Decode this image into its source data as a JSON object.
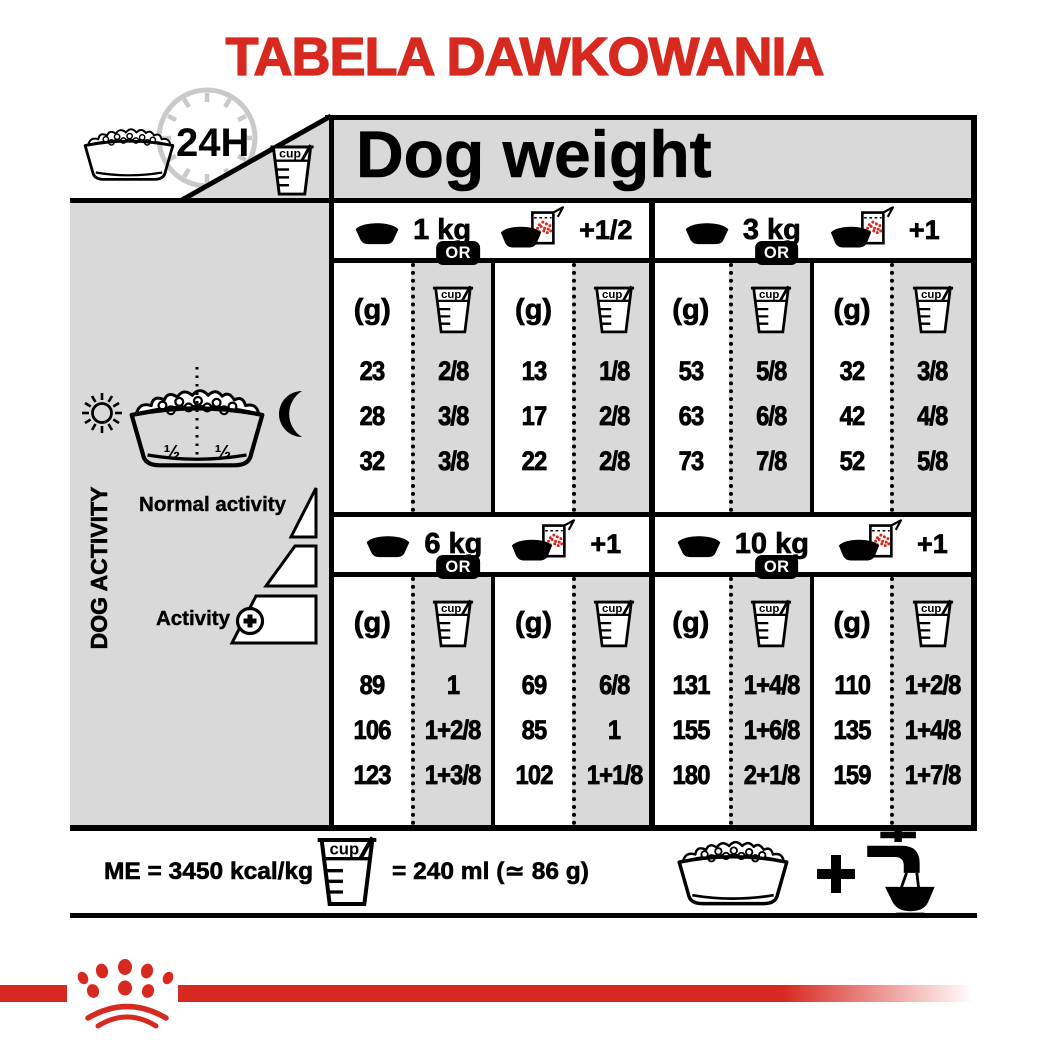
{
  "title": "TABELA DAWKOWANIA",
  "header": {
    "clock_label": "24H",
    "dog_weight_label": "Dog weight"
  },
  "sidebar": {
    "axis_label": "DOG ACTIVITY",
    "bowl_half_left": "½",
    "bowl_half_right": "½",
    "normal_activity_label": "Normal activity",
    "activity_label": "Activity"
  },
  "table": {
    "grams_header": "(g)",
    "cup_label": "cup",
    "or_label": "OR",
    "sections": [
      {
        "weight": "1 kg",
        "bag_extra": "+1/2",
        "bowl_grams": [
          "23",
          "28",
          "32"
        ],
        "bowl_cups": [
          "2/8",
          "3/8",
          "3/8"
        ],
        "bag_grams": [
          "13",
          "17",
          "22"
        ],
        "bag_cups": [
          "1/8",
          "2/8",
          "2/8"
        ]
      },
      {
        "weight": "3 kg",
        "bag_extra": "+1",
        "bowl_grams": [
          "53",
          "63",
          "73"
        ],
        "bowl_cups": [
          "5/8",
          "6/8",
          "7/8"
        ],
        "bag_grams": [
          "32",
          "42",
          "52"
        ],
        "bag_cups": [
          "3/8",
          "4/8",
          "5/8"
        ]
      },
      {
        "weight": "6 kg",
        "bag_extra": "+1",
        "bowl_grams": [
          "89",
          "106",
          "123"
        ],
        "bowl_cups": [
          "1",
          "1+2/8",
          "1+3/8"
        ],
        "bag_grams": [
          "69",
          "85",
          "102"
        ],
        "bag_cups": [
          "6/8",
          "1",
          "1+1/8"
        ]
      },
      {
        "weight": "10 kg",
        "bag_extra": "+1",
        "bowl_grams": [
          "131",
          "155",
          "180"
        ],
        "bowl_cups": [
          "1+4/8",
          "1+6/8",
          "2+1/8"
        ],
        "bag_grams": [
          "110",
          "135",
          "159"
        ],
        "bag_cups": [
          "1+2/8",
          "1+4/8",
          "1+7/8"
        ]
      }
    ]
  },
  "footer": {
    "me_label": "ME = 3450 kcal/kg",
    "cup_equivalence": "= 240 ml (≃ 86 g)"
  },
  "colors": {
    "red": "#d7291f",
    "gray": "#d9d9d9",
    "black": "#000000"
  }
}
